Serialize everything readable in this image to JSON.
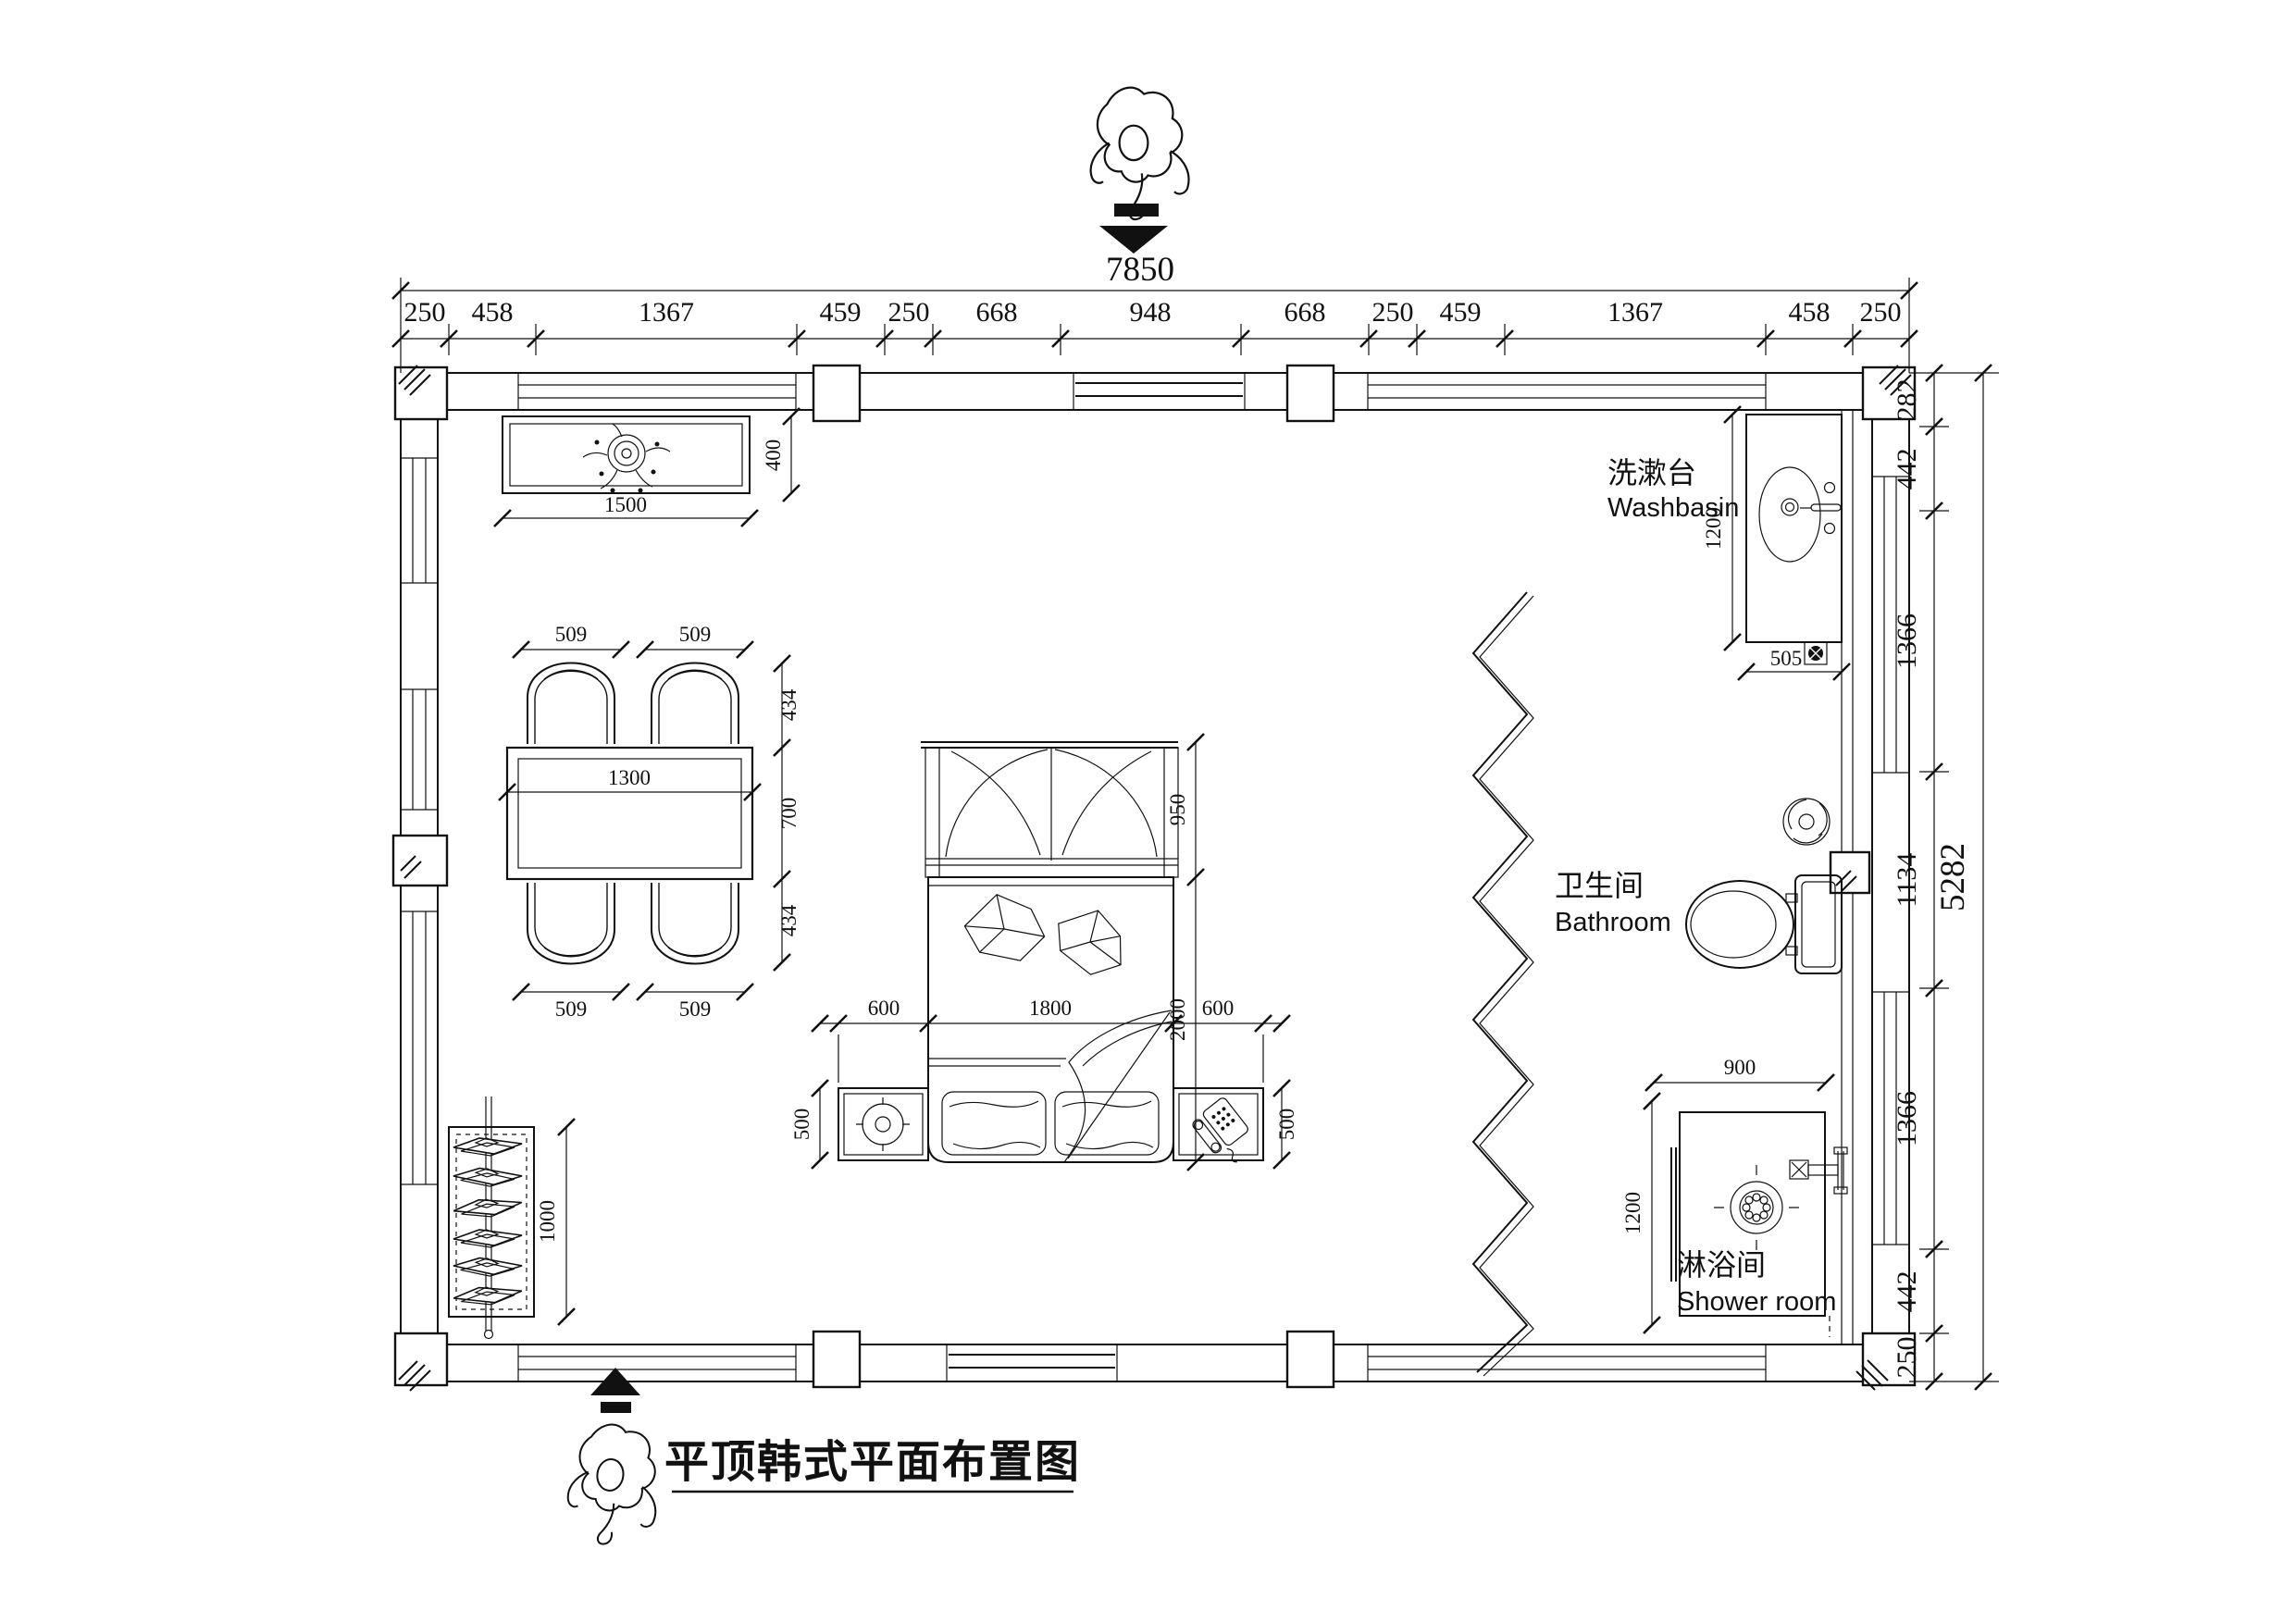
{
  "title": "平顶韩式平面布置图",
  "dims": {
    "total_width": "7850",
    "total_height": "5282",
    "top_chain": [
      "250",
      "458",
      "1367",
      "459",
      "250",
      "668",
      "948",
      "668",
      "250",
      "459",
      "1367",
      "458",
      "250"
    ],
    "right_chain": [
      "282",
      "442",
      "1366",
      "1134",
      "1366",
      "442",
      "250"
    ]
  },
  "labels": {
    "washbasin_zh": "洗漱台",
    "washbasin_en": "Washbasin",
    "bathroom_zh": "卫生间",
    "bathroom_en": "Bathroom",
    "shower_zh": "淋浴间",
    "shower_en": "Shower room"
  },
  "furniture": {
    "tv_console": {
      "w": "1500",
      "d": "400"
    },
    "dining": {
      "chair_w": "509",
      "seat_d": "434",
      "table_w": "1300",
      "table_d": "700"
    },
    "rack": {
      "len": "1000"
    },
    "bed": {
      "w": "1800",
      "len": "2000",
      "side": "600",
      "stand_d": "500",
      "cabinet_d": "950"
    },
    "basin": {
      "len": "1200",
      "w": "505"
    },
    "shower": {
      "w": "900",
      "d": "1200"
    }
  }
}
